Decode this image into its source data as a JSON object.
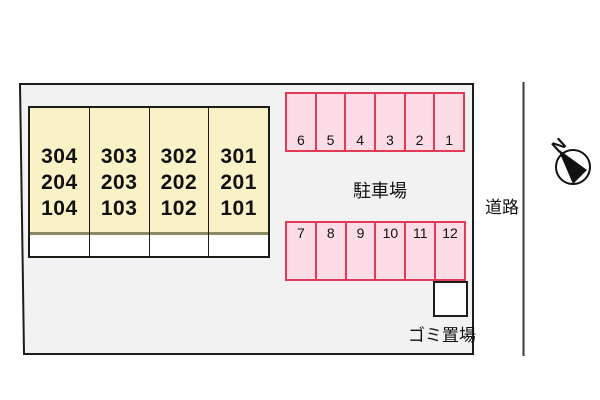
{
  "building": {
    "columns": [
      {
        "rooms": [
          "304",
          "204",
          "104"
        ]
      },
      {
        "rooms": [
          "303",
          "203",
          "103"
        ]
      },
      {
        "rooms": [
          "302",
          "202",
          "102"
        ]
      },
      {
        "rooms": [
          "301",
          "201",
          "101"
        ]
      }
    ]
  },
  "parking": {
    "label": "駐車場",
    "top_row": [
      "6",
      "5",
      "4",
      "3",
      "2",
      "1"
    ],
    "bottom_row": [
      "7",
      "8",
      "9",
      "10",
      "11",
      "12"
    ]
  },
  "garbage": {
    "label": "ゴミ置場"
  },
  "road": {
    "label": "道路"
  },
  "compass": {
    "north": "N"
  },
  "colors": {
    "site-fill": "#f2f2f2",
    "building-fill": "#f9f2c6",
    "building-divider": "#8a8a68",
    "parking-fill": "#fcdce7",
    "parking-border": "#e23b55"
  }
}
